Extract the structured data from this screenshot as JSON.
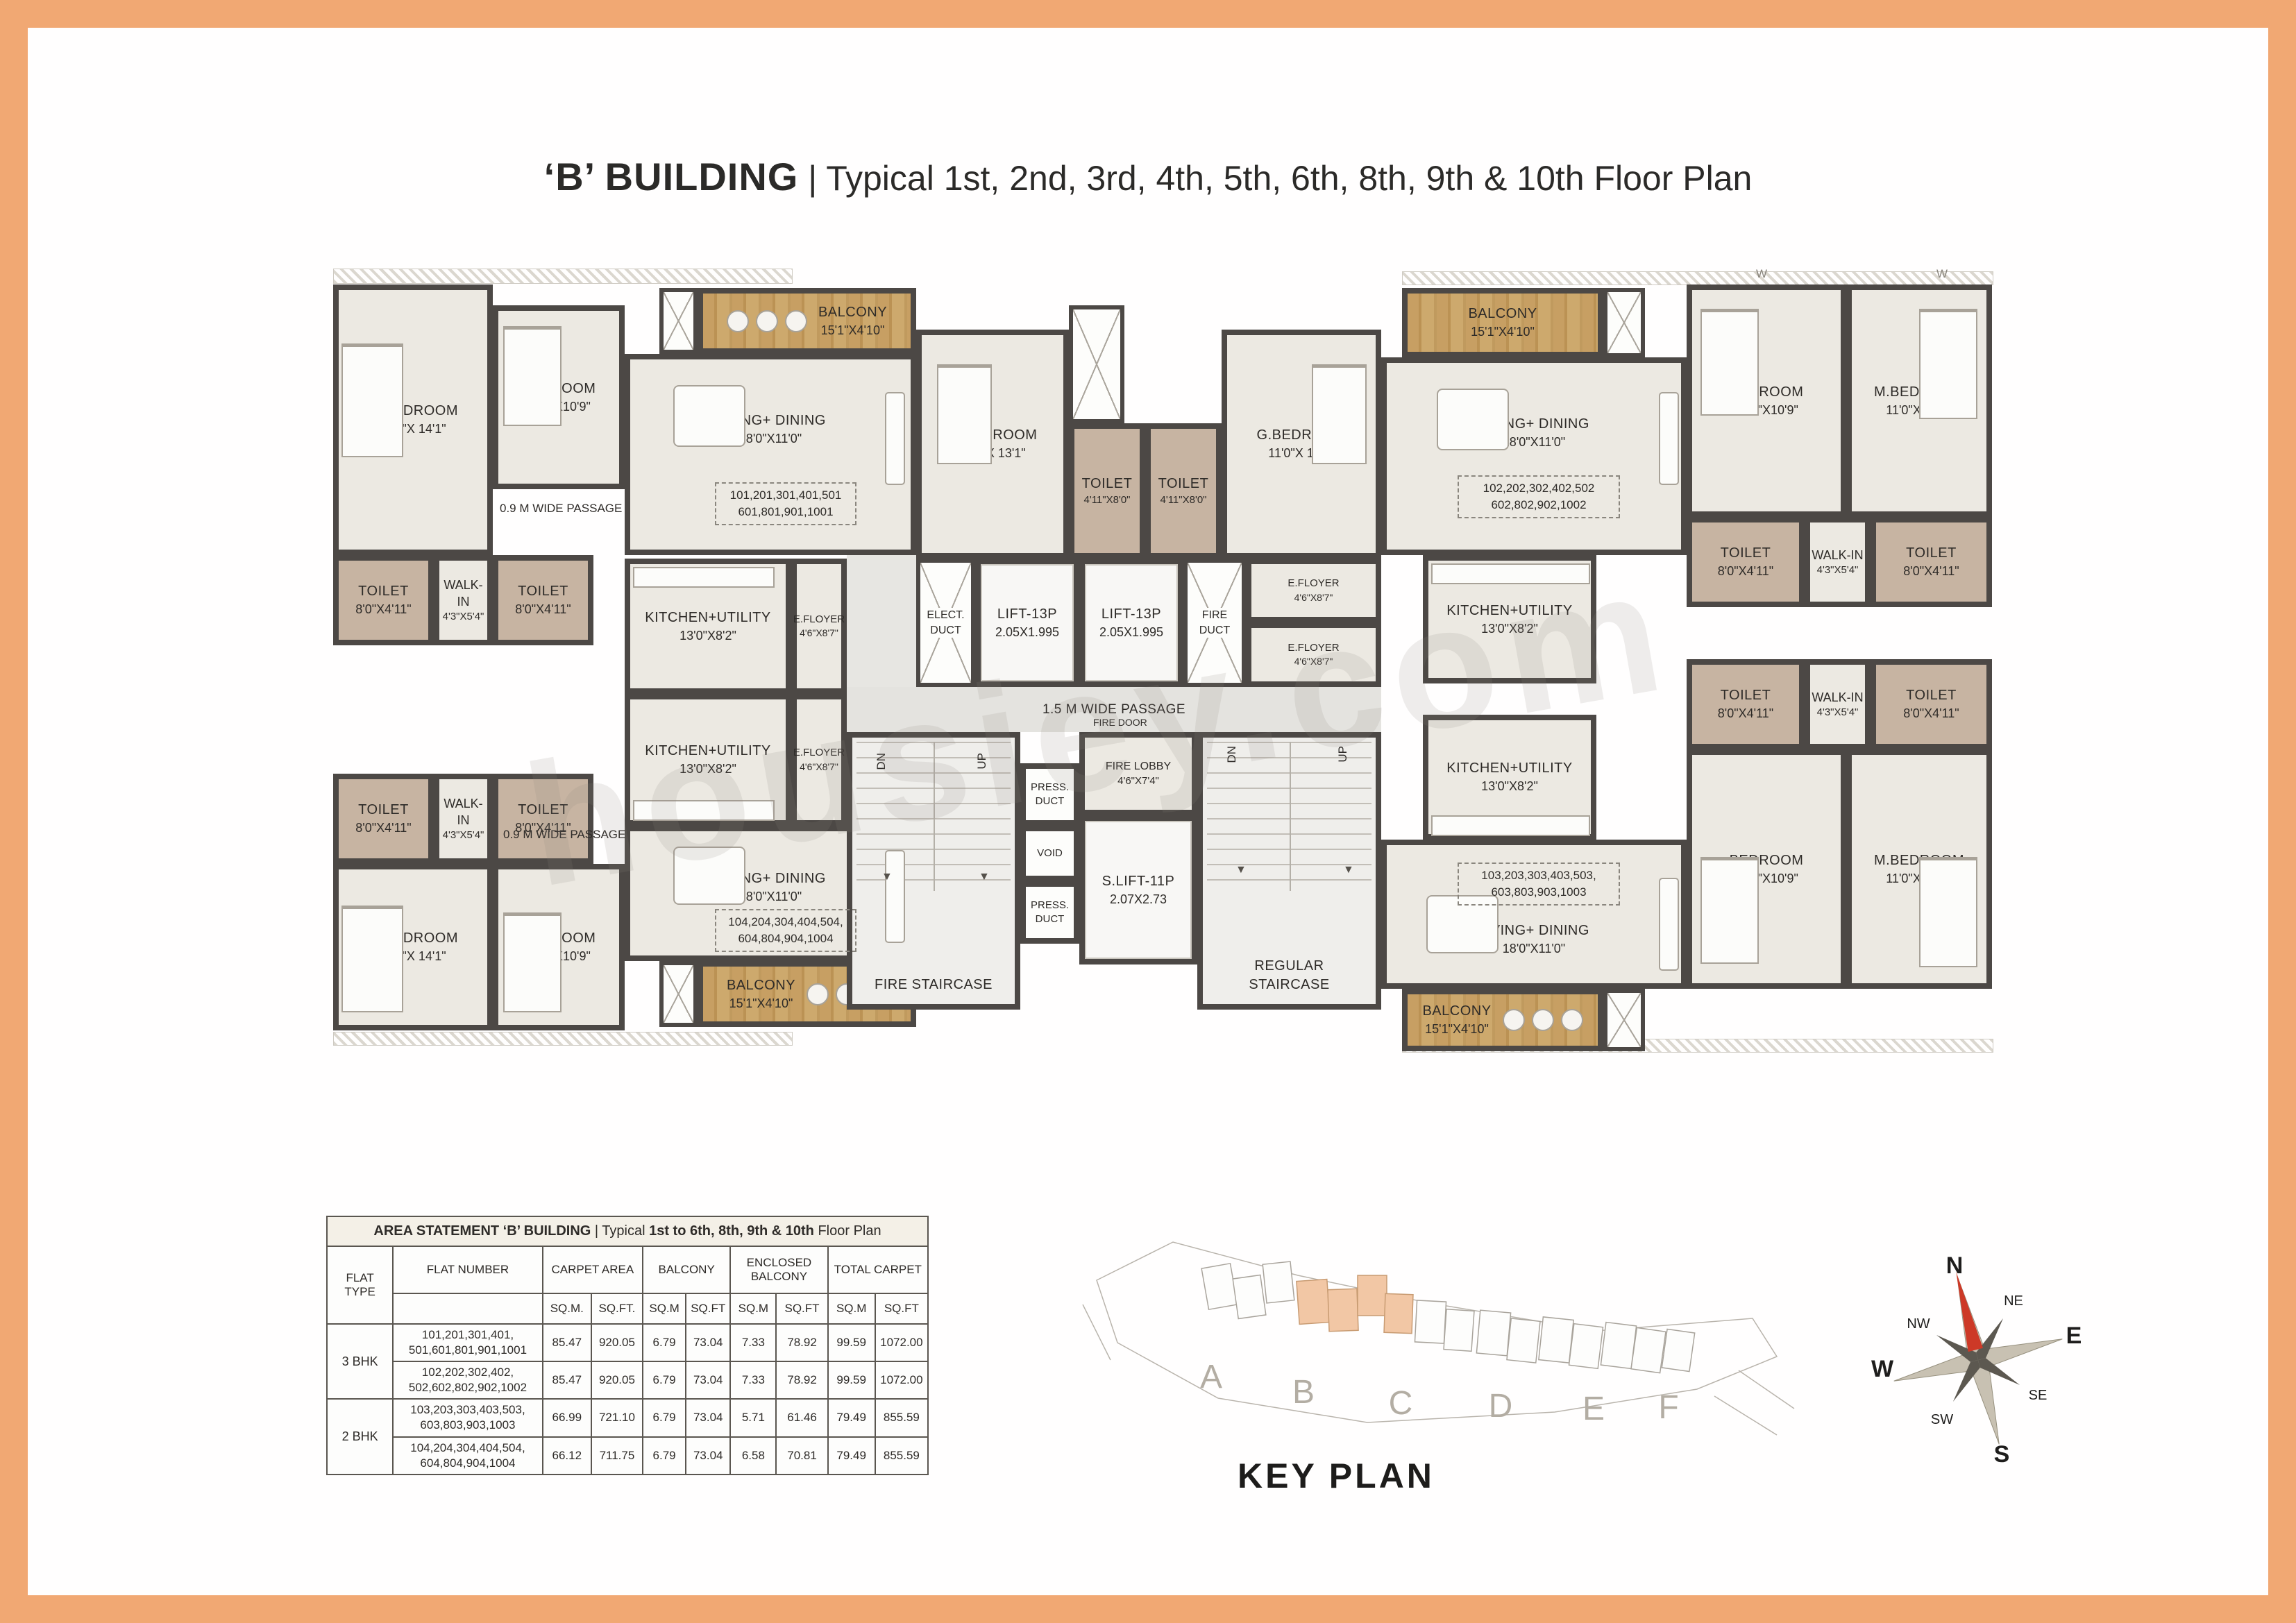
{
  "page": {
    "title_bold": "‘B’ BUILDING",
    "title_rest": " | Typical 1st, 2nd, 3rd, 4th, 5th, 6th, 8th, 9th & 10th Floor Plan",
    "key_plan_label": "KEY PLAN",
    "watermark": "housiey.com",
    "colors": {
      "border_orange": "#F1A873",
      "wall": "#4C4845",
      "floor": "#ECE9E2",
      "toilet": "#C7B4A2",
      "balcony_wood": "#C59F63",
      "keyplan_highlight": "#F2C7A5",
      "compass_north": "#CD3927"
    }
  },
  "plan": {
    "passage_09": "0.9 M WIDE PASSAGE",
    "passage_15": "1.5 M WIDE PASSAGE",
    "fire_door": "FIRE DOOR",
    "window": "W",
    "dn": "DN",
    "up": "UP",
    "rooms": {
      "mbed": {
        "name": "M.BEDROOM",
        "dims": "11'0\"X 14'1\""
      },
      "bed": {
        "name": "BEDROOM",
        "dims": "10'0\"X10'9\""
      },
      "gbed": {
        "name": "G.BEDROOM",
        "dims": "11'0\"X 13'1\""
      },
      "living": {
        "name": "LIVING+ DINING",
        "dims": "18'0\"X11'0\""
      },
      "kitchen": {
        "name": "KITCHEN+UTILITY",
        "dims": "13'0\"X8'2\""
      },
      "toilet_s": {
        "name": "TOILET",
        "dims": "8'0\"X4'11\""
      },
      "toilet_c": {
        "name": "TOILET",
        "dims": "4'11\"X8'0\""
      },
      "walkin": {
        "name": "WALK-IN",
        "dims": "4'3\"X5'4\""
      },
      "balcony": {
        "name": "BALCONY",
        "dims": "15'1\"X4'10\""
      },
      "efloyer": {
        "name": "E.FLOYER",
        "dims": "4'6\"X8'7\""
      },
      "lift": {
        "name": "LIFT-13P",
        "dims": "2.05X1.995"
      },
      "slift": {
        "name": "S.LIFT-11P",
        "dims": "2.07X2.73"
      },
      "elect": {
        "name": "ELECT.",
        "name2": "DUCT"
      },
      "fireduct": {
        "name": "FIRE",
        "name2": "DUCT"
      },
      "pressduct": {
        "name": "PRESS.",
        "name2": "DUCT"
      },
      "voidroom": {
        "name": "VOID"
      },
      "firelobby": {
        "name": "FIRE LOBBY",
        "dims": "4'6\"X7'4\""
      },
      "firestair": {
        "name": "FIRE STAIRCASE"
      },
      "regstair": {
        "name": "REGULAR",
        "name2": "STAIRCASE"
      }
    },
    "flats": {
      "f101": {
        "l1": "101,201,301,401,501",
        "l2": "601,801,901,1001"
      },
      "f102": {
        "l1": "102,202,302,402,502",
        "l2": "602,802,902,1002"
      },
      "f103": {
        "l1": "103,203,303,403,503,",
        "l2": "603,803,903,1003"
      },
      "f104": {
        "l1": "104,204,304,404,504,",
        "l2": "604,804,904,1004"
      }
    }
  },
  "area_table": {
    "title_seg1": "AREA STATEMENT ‘B’ BUILDING",
    "title_seg2": " | Typical ",
    "title_seg3": "1st to 6th, 8th, 9th & 10th",
    "title_seg4": " Floor Plan",
    "col_flat_type": "FLAT TYPE",
    "col_flat_number": "FLAT NUMBER",
    "col_carpet": "CARPET AREA",
    "col_balcony": "BALCONY",
    "col_enclosed": "ENCLOSED BALCONY",
    "col_total": "TOTAL CARPET",
    "sub": [
      "SQ.M.",
      "SQ.FT.",
      "SQ.M",
      "SQ.FT",
      "SQ.M",
      "SQ.FT",
      "SQ.M",
      "SQ.FT"
    ],
    "rows": [
      {
        "flat_type": "3 BHK",
        "fn1": "101,201,301,401,",
        "fn2": "501,601,801,901,1001",
        "values": [
          "85.47",
          "920.05",
          "6.79",
          "73.04",
          "7.33",
          "78.92",
          "99.59",
          "1072.00"
        ]
      },
      {
        "flat_type": "",
        "fn1": "102,202,302,402,",
        "fn2": "502,602,802,902,1002",
        "values": [
          "85.47",
          "920.05",
          "6.79",
          "73.04",
          "7.33",
          "78.92",
          "99.59",
          "1072.00"
        ]
      },
      {
        "flat_type": "2 BHK",
        "fn1": "103,203,303,403,503,",
        "fn2": "603,803,903,1003",
        "values": [
          "66.99",
          "721.10",
          "6.79",
          "73.04",
          "5.71",
          "61.46",
          "79.49",
          "855.59"
        ]
      },
      {
        "flat_type": "",
        "fn1": "104,204,304,404,504,",
        "fn2": "604,804,904,1004",
        "values": [
          "66.12",
          "711.75",
          "6.79",
          "73.04",
          "6.58",
          "70.81",
          "79.49",
          "855.59"
        ]
      }
    ]
  },
  "key_plan": {
    "letters": [
      "A",
      "B",
      "C",
      "D",
      "E",
      "F"
    ]
  },
  "compass": {
    "n": "N",
    "ne": "NE",
    "e": "E",
    "se": "SE",
    "s": "S",
    "sw": "SW",
    "w": "W",
    "nw": "NW"
  }
}
